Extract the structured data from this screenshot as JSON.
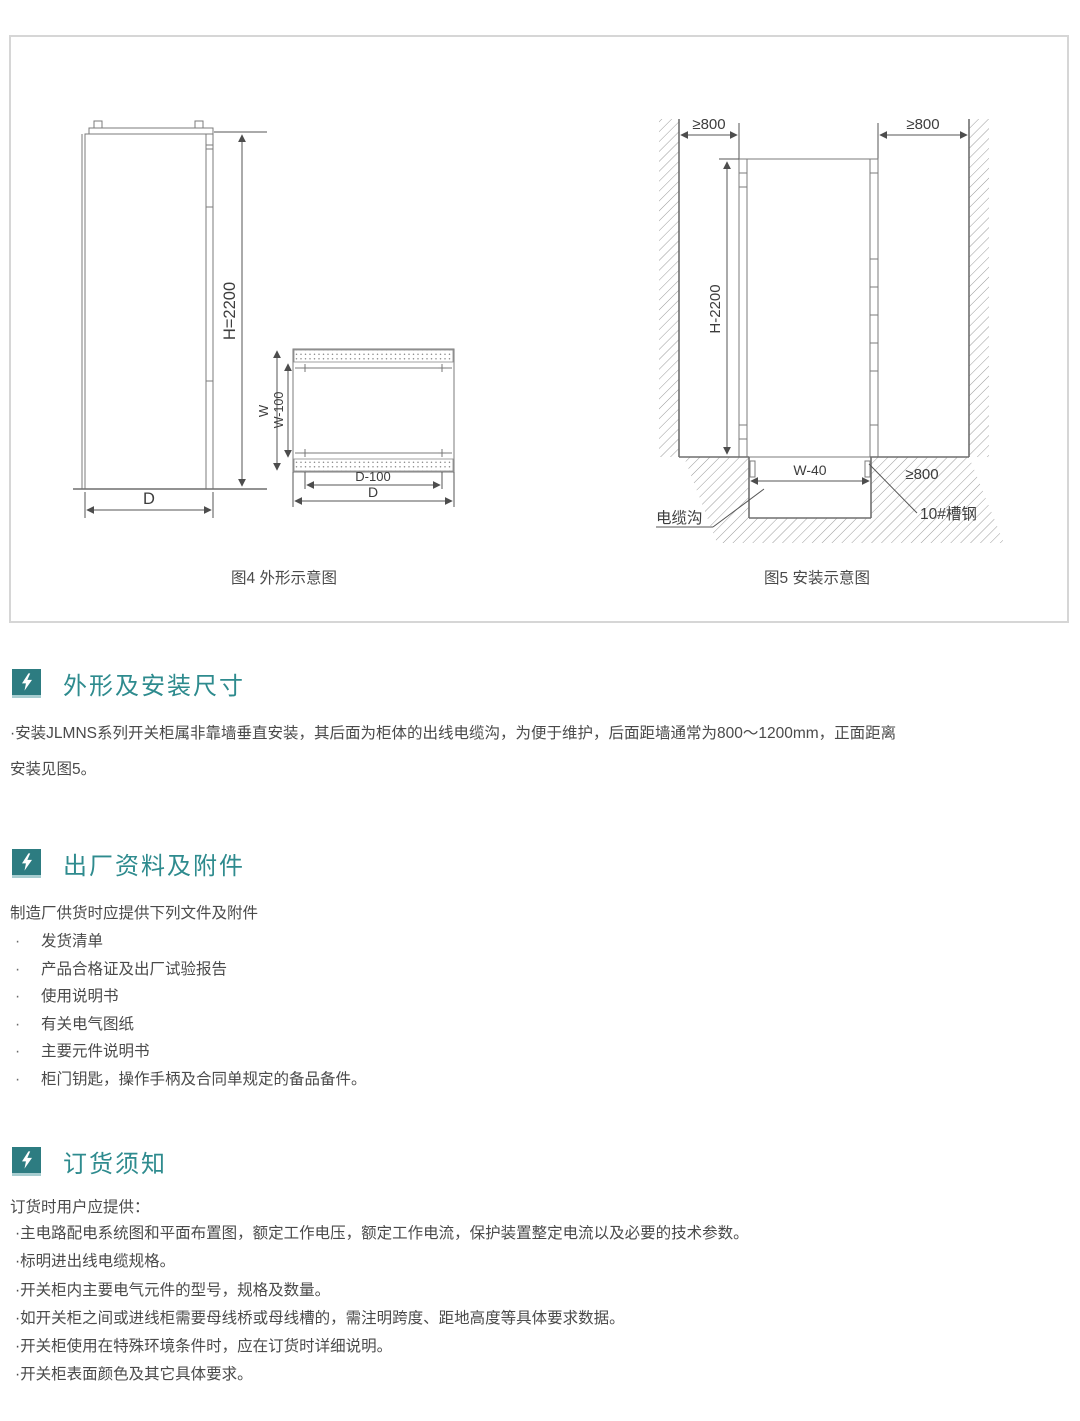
{
  "figures": {
    "fig4": {
      "caption": "图4 外形示意图",
      "labels": {
        "h": "H=2200",
        "d_front": "D",
        "w": "W",
        "w100": "W-100",
        "d100": "D-100",
        "d_top": "D"
      }
    },
    "fig5": {
      "caption": "图5 安装示意图",
      "labels": {
        "left_clearance": "≥800",
        "right_clearance": "≥800",
        "h": "H-2200",
        "w40": "W-40",
        "rear_clearance": "≥800",
        "cable_trench": "电缆沟",
        "channel_steel": "10#槽钢"
      }
    }
  },
  "sections": [
    {
      "title": "外形及安装尺寸",
      "lines": [
        "·安装JLMNS系列开关柜属非靠墙垂直安装，其后面为柜体的出线电缆沟，为便于维护，后面距墙通常为800～1200mm，正面距离",
        "安装见图5。"
      ]
    },
    {
      "title": "出厂资料及附件",
      "intro": "制造厂供货时应提供下列文件及附件",
      "bullet": "·",
      "items": [
        "发货清单",
        "产品合格证及出厂试验报告",
        "使用说明书",
        "有关电气图纸",
        "主要元件说明书",
        "柜门钥匙，操作手柄及合同单规定的备品备件。"
      ]
    },
    {
      "title": "订货须知",
      "intro": "订货时用户应提供：",
      "bullet": "·",
      "items": [
        "主电路配电系统图和平面布置图，额定工作电压，额定工作电流，保护装置整定电流以及必要的技术参数。",
        "标明进出线电缆规格。",
        "开关柜内主要电气元件的型号，规格及数量。",
        "如开关柜之间或进线柜需要母线桥或母线槽的，需注明跨度、距地高度等具体要求数据。",
        "开关柜使用在特殊环境条件时，应在订货时详细说明。",
        "开关柜表面颜色及其它具体要求。"
      ]
    }
  ]
}
